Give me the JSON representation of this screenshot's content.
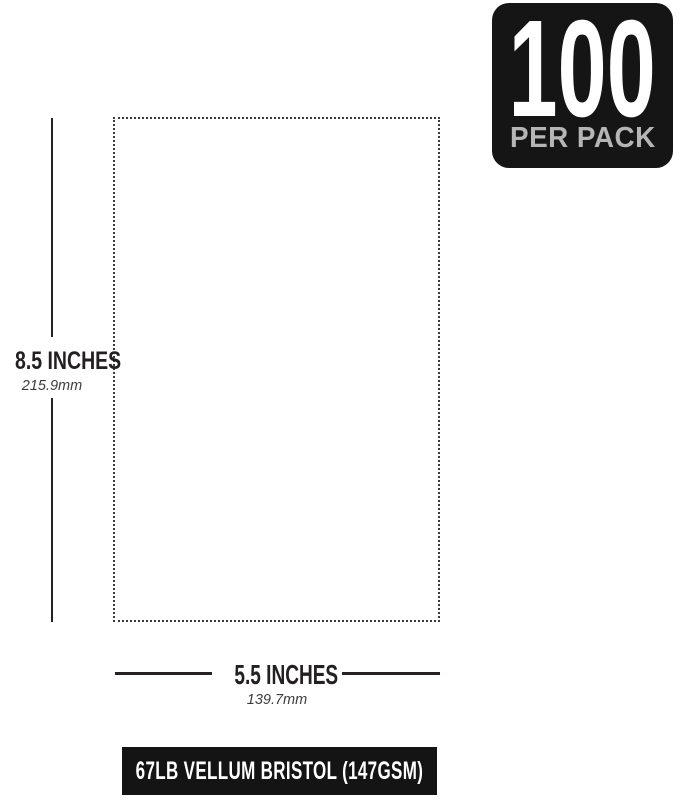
{
  "badge": {
    "count": "100",
    "label": "PER PACK"
  },
  "height_dimension": {
    "inches": "8.5 INCHES",
    "metric": "215.9mm"
  },
  "width_dimension": {
    "inches": "5.5 INCHES",
    "metric": "139.7mm"
  },
  "footer": {
    "label": "67LB VELLUM BRISTOL (147GSM)"
  },
  "colors": {
    "background": "#ffffff",
    "badge_bg": "#151515",
    "badge_count_text": "#ffffff",
    "badge_label_text": "#b5b5b5",
    "dimension_text": "#232021",
    "metric_text": "#3c3c3c",
    "line": "#262223",
    "paper_outline_dots": "#3a3a3a",
    "footer_bg": "#141414",
    "footer_text": "#ffffff"
  }
}
